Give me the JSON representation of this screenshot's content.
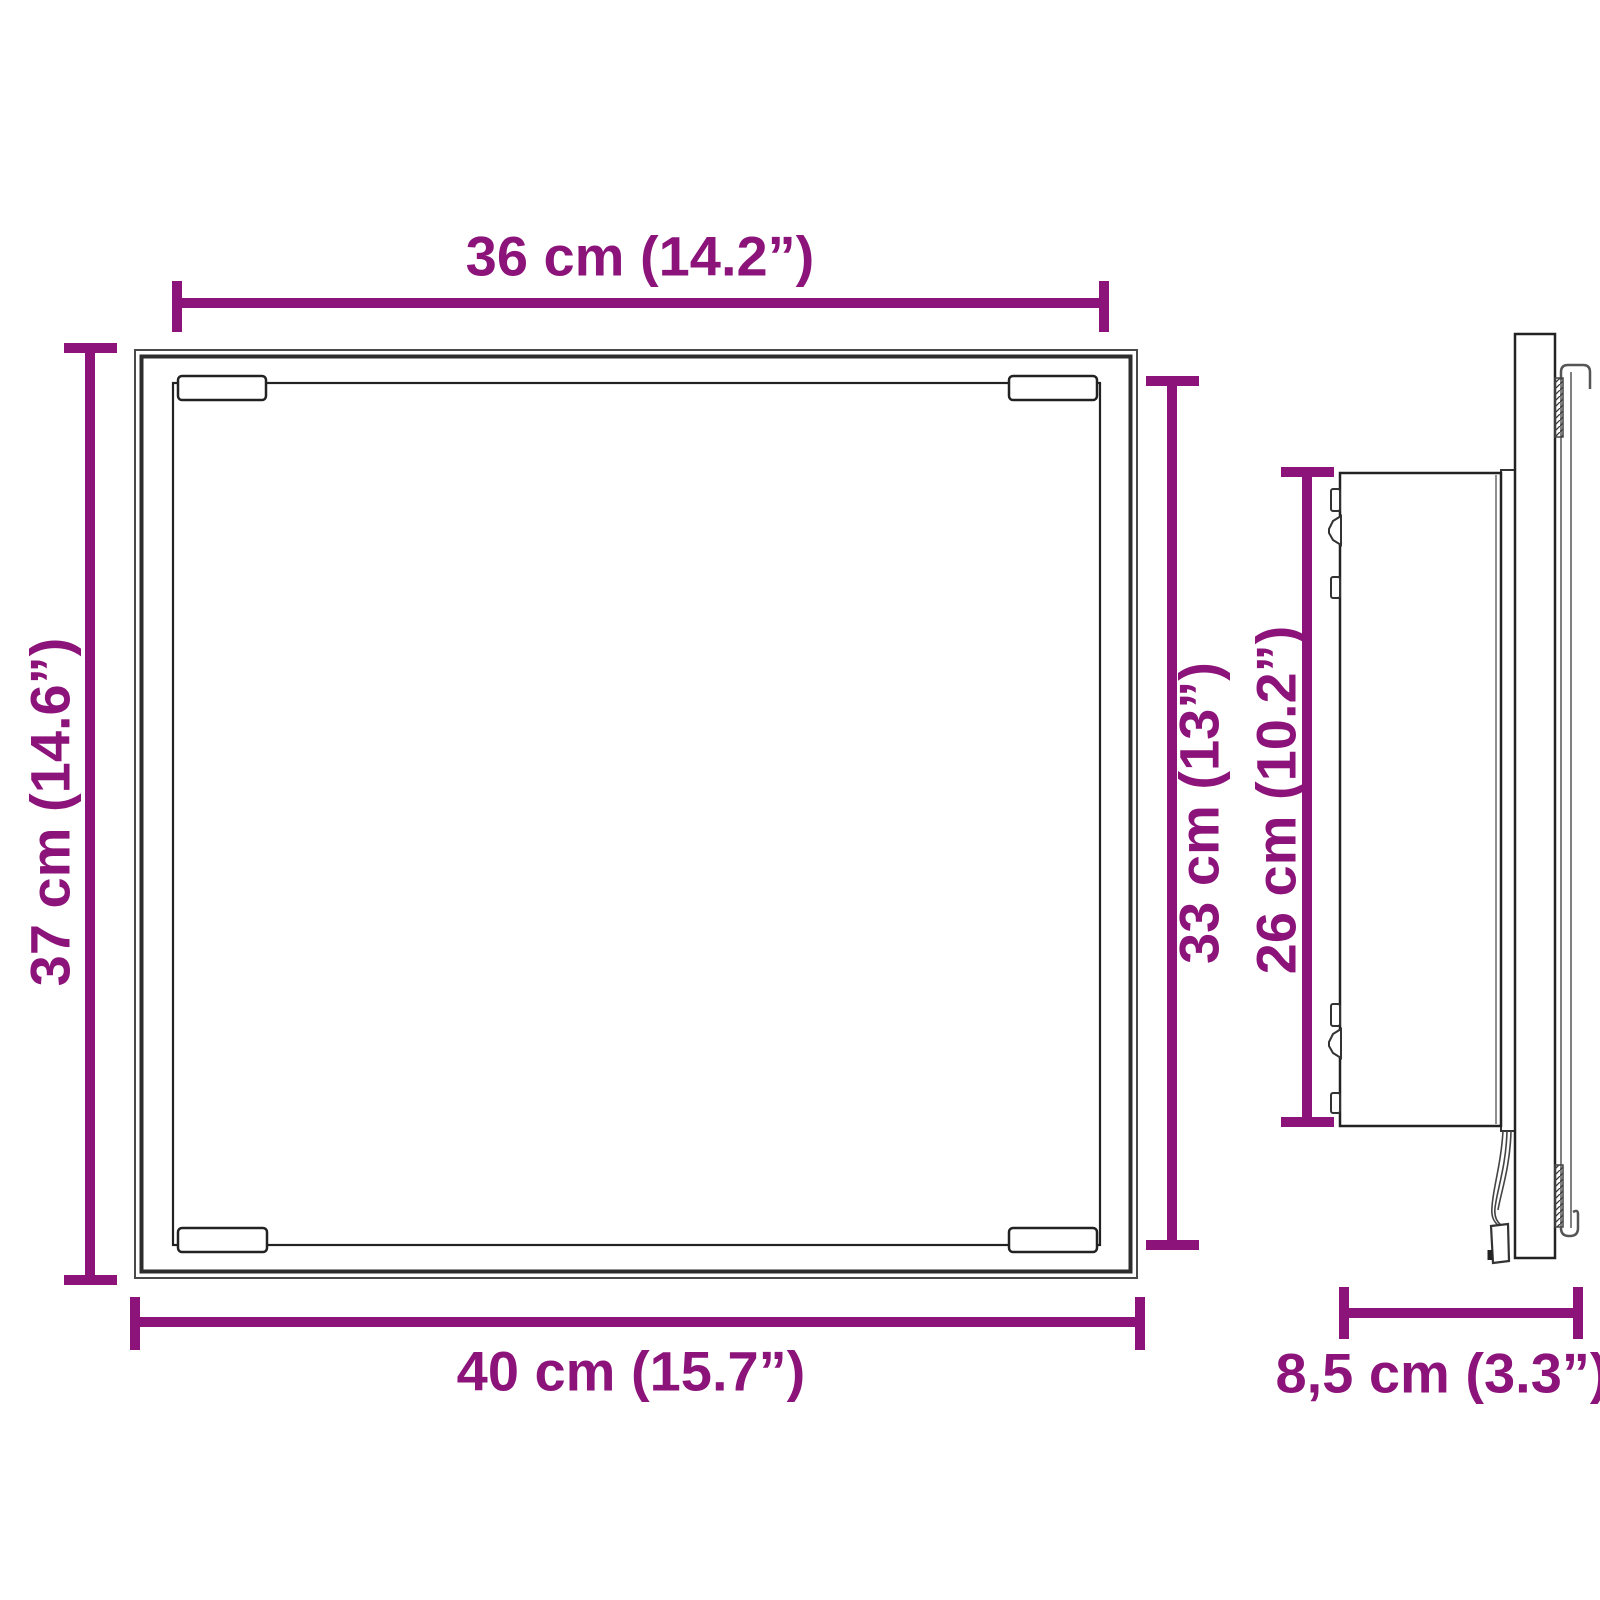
{
  "colors": {
    "dimension_accent": "#8B1379",
    "outline_dark": "#2D2D2D"
  },
  "dimensions": {
    "glass_width": {
      "label": "36 cm (14.2”)",
      "value_cm": "36",
      "value_in": "14.2"
    },
    "frame_height": {
      "label": "37 cm (14.6”)",
      "value_cm": "37",
      "value_in": "14.6"
    },
    "glass_height": {
      "label": "33 cm (13”)",
      "value_cm": "33",
      "value_in": "13"
    },
    "frame_width": {
      "label": "40 cm (15.7”)",
      "value_cm": "40",
      "value_in": "15.7"
    },
    "housing_height": {
      "label": "26 cm (10.2”)",
      "value_cm": "26",
      "value_in": "10.2"
    },
    "depth": {
      "label": "8,5 cm (3.3”)",
      "value_cm": "8,5",
      "value_in": "3.3"
    }
  }
}
